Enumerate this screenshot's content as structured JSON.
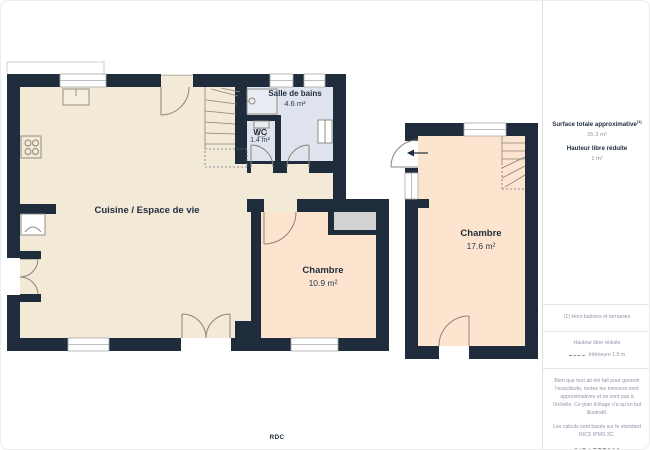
{
  "plan": {
    "floor_label": "RDC",
    "rooms": [
      {
        "id": "kitchen",
        "name": "Cuisine / Espace de vie",
        "area": ""
      },
      {
        "id": "bathroom",
        "name": "Salle de bains",
        "area": "4.6 m²"
      },
      {
        "id": "wc",
        "name": "WC",
        "area": "1.4 m²"
      },
      {
        "id": "bedroom1",
        "name": "Chambre",
        "area": "10.9 m²"
      },
      {
        "id": "bedroom2",
        "name": "Chambre",
        "area": "17.6 m²"
      }
    ]
  },
  "sidebar": {
    "surface_title": "Surface totale approximative",
    "surface_note_marker": "(1)",
    "surface_value": "35.3 m²",
    "height_title": "Hauteur libre réduite",
    "height_value": "1 m²",
    "footnote": "(1) Hors balcons et terrasses",
    "legend_title": "Hauteur libre réduite",
    "legend_item": "Inférieure 1.5 m",
    "disclaimer": "Bien que tout ait été fait pour garantir l'exactitude, toutes les mesures sont approximatives et ne sont pas à l'échelle. Ce plan d'étage n'a qu'un but illustratif.",
    "standard_note": "Les calculs sont basés sur le standard RICS IPMS 3C.",
    "brand": "GIRAFFE",
    "brand_suffix": "360"
  },
  "colors": {
    "wall": "#1f2c3c",
    "kitchen_floor": "#f2e9d7",
    "bedroom_floor": "#fce4cf",
    "bathroom_floor": "#e0e4ee",
    "closet": "#d2d2d2",
    "fixture_line": "#8a8478",
    "window_line": "#a9a9a9",
    "text": "#1f2c3c",
    "muted_text": "#8d96a6",
    "divider": "#e4e4e4"
  }
}
